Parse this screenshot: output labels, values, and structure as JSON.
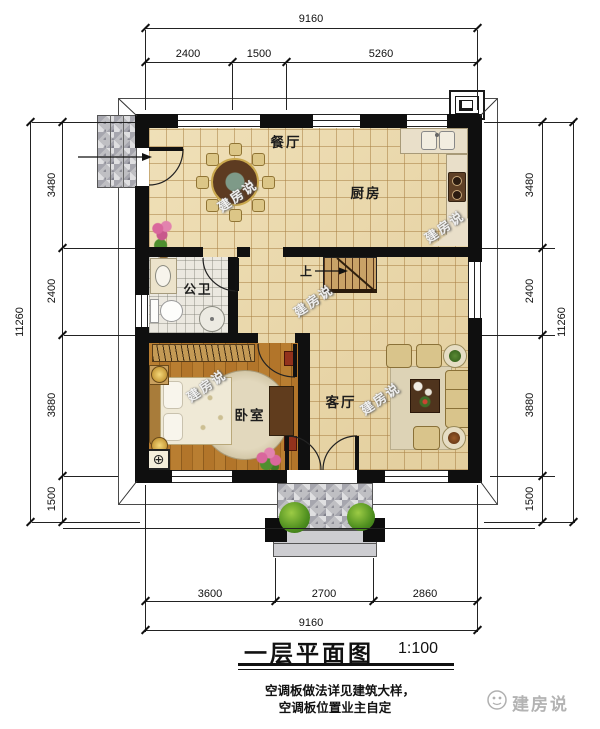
{
  "title_block": {
    "title": "一层平面图",
    "scale": "1:100",
    "note_line1": "空调板做法详见建筑大样，",
    "note_line2": "空调板位置业主自定",
    "brand": "建房说"
  },
  "watermark_text": "建房说",
  "rooms": {
    "dining_room": "餐厅",
    "kitchen": "厨房",
    "bathroom": "公卫",
    "bedroom": "卧室",
    "living_room": "客厅",
    "stair_direction": "上"
  },
  "dimensions": {
    "top": {
      "total": "9160",
      "segments": [
        "2400",
        "1500",
        "5260"
      ]
    },
    "bottom": {
      "total": "9160",
      "segments": [
        "3600",
        "2700",
        "2860"
      ]
    },
    "left": {
      "total": "11260",
      "segments": [
        "3480",
        "2400",
        "3880",
        "1500"
      ]
    },
    "right": {
      "total": "11260",
      "segments": [
        "3480",
        "2400",
        "3880",
        "1500"
      ]
    }
  },
  "colors": {
    "wall": "#0f0f0f",
    "floor_tile": "#ecd9a8",
    "bath_tile": "#ebe8e0",
    "wood_floor": "#b0752c",
    "porch_tile": "#bfbfc3",
    "furniture_tan": "#d9c48b",
    "dark_wood": "#5d3b21"
  }
}
